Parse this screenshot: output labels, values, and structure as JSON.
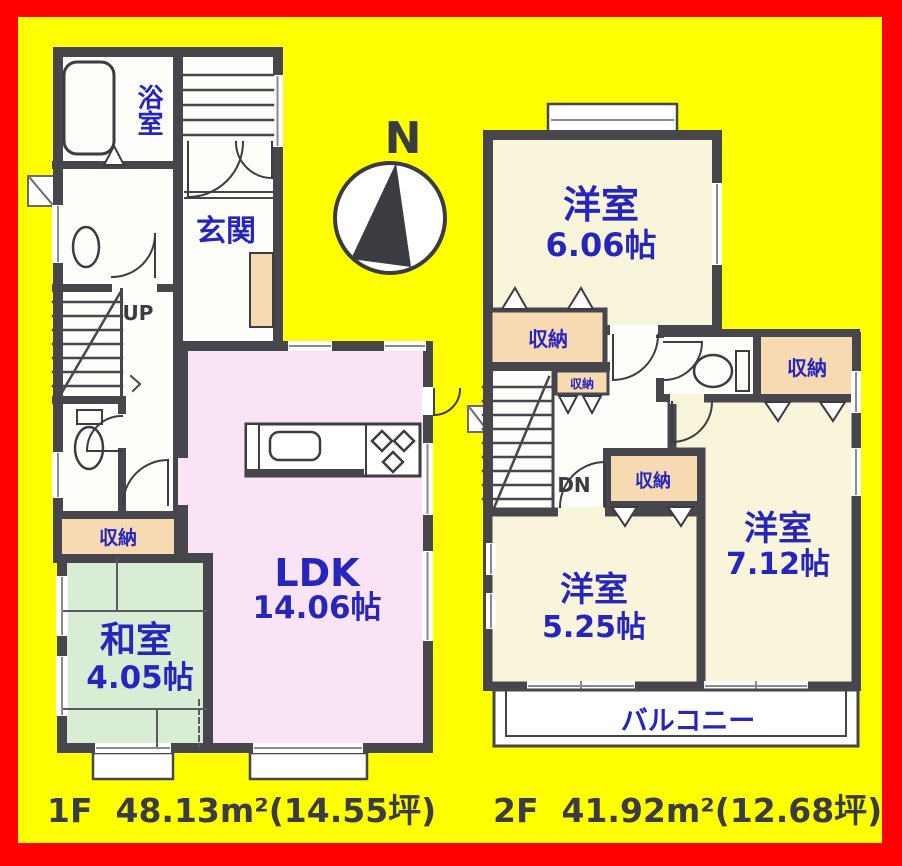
{
  "page": {
    "background": "#ffff00",
    "border_color": "#ff0000",
    "wall_color": "#46464c"
  },
  "compass": {
    "north_label": "N"
  },
  "floor1": {
    "area_label": "1F  48.13m²(14.55坪)",
    "rooms": {
      "bathroom": "浴室",
      "entrance": "玄関",
      "stairs_label": "UP",
      "storage": "収納",
      "japanese_room_name": "和室",
      "japanese_room_size": "4.05帖",
      "ldk_name": "LDK",
      "ldk_size": "14.06帖"
    }
  },
  "floor2": {
    "area_label": "2F  41.92m²(12.68坪)",
    "rooms": {
      "bedroom1_name": "洋室",
      "bedroom1_size": "6.06帖",
      "storage1": "収納",
      "storage2": "収納",
      "storage3": "収納",
      "storage4": "収納",
      "stairs_label": "DN",
      "bedroom2_name": "洋室",
      "bedroom2_size": "7.12帖",
      "bedroom3_name": "洋室",
      "bedroom3_size": "5.25帖",
      "balcony": "バルコニー"
    }
  }
}
